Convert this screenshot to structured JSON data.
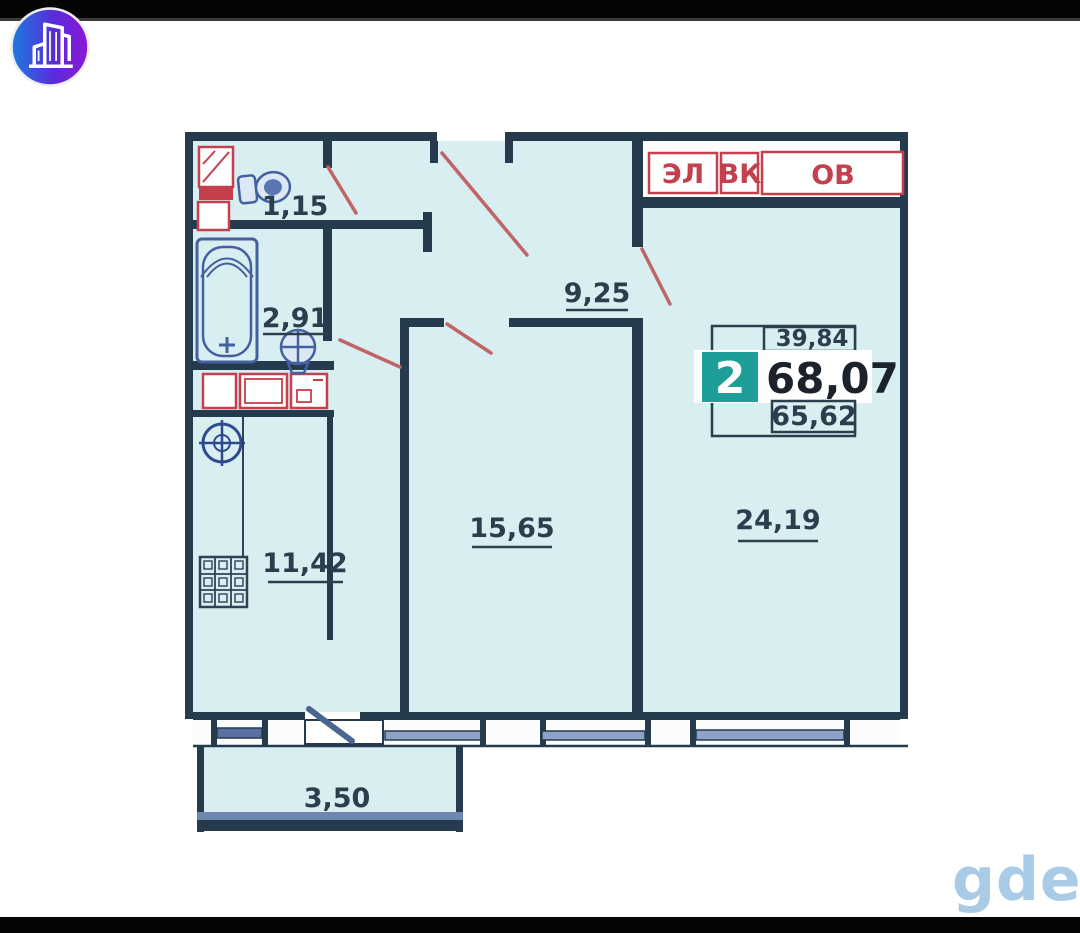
{
  "page": {
    "watermark": "gde"
  },
  "logo": {
    "icon": "buildings-logo-icon"
  },
  "plan": {
    "info_box": {
      "rooms_badge": "2",
      "total_area": "68,07",
      "living_area": "39,84",
      "area_without_balcony": "65,62"
    },
    "utility_boxes": [
      {
        "label": "ЭЛ"
      },
      {
        "label": "ВК"
      },
      {
        "label": "ОВ"
      }
    ],
    "rooms": [
      {
        "name": "wc",
        "area": "1,15"
      },
      {
        "name": "bathroom",
        "area": "2,91"
      },
      {
        "name": "hallway",
        "area": "9,25"
      },
      {
        "name": "kitchen",
        "area": "11,42"
      },
      {
        "name": "bedroom",
        "area": "15,65"
      },
      {
        "name": "living-room",
        "area": "24,19"
      },
      {
        "name": "balcony",
        "area": "3,50"
      }
    ],
    "icons": {
      "fixtures": [
        "toilet-icon",
        "bathtub-icon",
        "sink-icon",
        "ventilation-icon",
        "grille-icon",
        "stove-icon",
        "electric-panel-icon"
      ]
    },
    "colors": {
      "wall": "#263a4d",
      "interior": "#d8eef1",
      "red": "#c4404d",
      "door_swing": "#c06468",
      "fixture_blue": "#44609f",
      "teal_badge": "#1d9e99",
      "window_glass": "#8ea2c8",
      "watermark_blue": "#a9cbe6"
    }
  }
}
